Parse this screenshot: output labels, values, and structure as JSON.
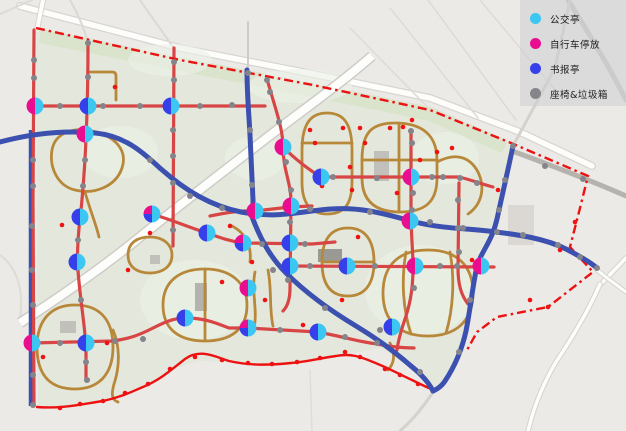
{
  "legend": {
    "items": [
      {
        "label": "公交亭",
        "color": "#3cc6f2"
      },
      {
        "label": "自行车停放",
        "color": "#e90e8f"
      },
      {
        "label": "书报亭",
        "color": "#3640ea"
      },
      {
        "label": "座椅&垃圾箱",
        "color": "#85858a"
      }
    ]
  },
  "map": {
    "colors": {
      "background": "#eceae7",
      "park_fill": "#e2e7da",
      "green_strip": "#d7e3c8",
      "field": "#edf1e8",
      "tan_path": "#b8883a",
      "red_road": "#d84545",
      "boundary_red": "#ec1212",
      "blue_route": "#3c50b0",
      "white_band": "#fdfdfc",
      "band_casing": "#cfccc7",
      "gray_dot": "#84848a",
      "red_dot": "#f01212",
      "marker_cyan": "#3cc6f2",
      "marker_magenta": "#e90e8f",
      "marker_blue": "#3640ea"
    },
    "outside_roads": [
      {
        "d": "M20,6 L180,48 L313,74 L430,98 L520,132 L592,166",
        "c": "#d8d5d0",
        "w": 8
      },
      {
        "d": "M20,6 L180,48 L313,74 L430,98 L520,132 L592,166",
        "c": "#fdfdfc",
        "w": 5.5
      },
      {
        "d": "M43,0 L37,30",
        "c": "#d8d5d0",
        "w": 6
      },
      {
        "d": "M43,0 L37,30",
        "c": "#fdfdfc",
        "w": 4
      },
      {
        "d": "M0,14 L32,0",
        "c": "#dedbd6",
        "w": 2
      },
      {
        "d": "M70,0 C78,14 84,28 88,42",
        "c": "#dcd9d4",
        "w": 2
      },
      {
        "d": "M140,0 C152,18 164,33 174,49",
        "c": "#dcd9d4",
        "w": 2
      },
      {
        "d": "M248,22 L248,70",
        "c": "#d0cdc8",
        "w": 2
      },
      {
        "d": "M390,8 L478,118",
        "c": "#dedbd6",
        "w": 1.5
      },
      {
        "d": "M428,0 L516,120",
        "c": "#dedbd6",
        "w": 1.5
      },
      {
        "d": "M350,28 L448,128",
        "c": "#dedbd6",
        "w": 1.5
      },
      {
        "d": "M480,0 L560,96",
        "c": "#dedbd6",
        "w": 1.5
      },
      {
        "d": "M568,0 C590,35 612,72 626,100",
        "c": "#cac7c2",
        "w": 5
      },
      {
        "d": "M513,146 L555,68 L570,0",
        "c": "#d5d2cd",
        "w": 3
      },
      {
        "d": "M515,152 C550,165 590,180 626,196",
        "c": "#b6b3ae",
        "w": 5
      },
      {
        "d": "M600,285 L626,258",
        "c": "#d5d2cd",
        "w": 5.5
      },
      {
        "d": "M600,285 L626,258",
        "c": "#fdfdfc",
        "w": 3.5
      },
      {
        "d": "M600,284 C588,312 572,338 556,362 C544,382 534,406 528,431",
        "c": "#d5d2cd",
        "w": 5.5
      },
      {
        "d": "M600,284 C588,312 572,338 556,362 C544,382 534,406 528,431",
        "c": "#fdfdfc",
        "w": 3.5
      },
      {
        "d": "M597,270 C608,279 618,286 626,292",
        "c": "#d5d2cd",
        "w": 5
      },
      {
        "d": "M597,270 C608,279 618,286 626,292",
        "c": "#fdfdfc",
        "w": 3
      },
      {
        "d": "M433,392 C420,412 410,422 400,431",
        "c": "#d5d2cd",
        "w": 3
      },
      {
        "d": "M310,370 L312,431",
        "c": "#e0ddd8",
        "w": 1.5
      },
      {
        "d": "M0,255 C18,268 24,292 20,318",
        "c": "#dedbd6",
        "w": 2
      }
    ],
    "park_outline": "36,28 180,58 313,84 430,108 513,146 505,190 494,226 479,252 471,300 461,345 440,390 410,367 380,348 350,354 312,359 270,365 228,362 200,361 170,370 143,388 115,396 80,405 38,408",
    "green_strip": "M40,36 L180,64 L313,90 L430,114 L505,147",
    "fields": [
      {
        "cx": 170,
        "cy": 60,
        "rx": 42,
        "ry": 16
      },
      {
        "cx": 300,
        "cy": 86,
        "rx": 52,
        "ry": 17
      },
      {
        "cx": 445,
        "cy": 158,
        "rx": 34,
        "ry": 26
      },
      {
        "cx": 120,
        "cy": 152,
        "rx": 38,
        "ry": 26
      },
      {
        "cx": 255,
        "cy": 158,
        "rx": 30,
        "ry": 22
      },
      {
        "cx": 195,
        "cy": 300,
        "rx": 55,
        "ry": 40
      },
      {
        "cx": 420,
        "cy": 290,
        "rx": 55,
        "ry": 45
      }
    ],
    "white_band": {
      "d": "M372,56 C335,88 300,112 264,140 C220,174 176,208 140,237 C102,268 60,297 20,323"
    },
    "buildings": [
      {
        "x": 318,
        "y": 249,
        "w": 24,
        "h": 13,
        "c": "#9b9993"
      },
      {
        "x": 374,
        "y": 151,
        "w": 15,
        "h": 30,
        "c": "#c2c0bb"
      },
      {
        "x": 195,
        "y": 283,
        "w": 12,
        "h": 28,
        "c": "#b5b3ae"
      },
      {
        "x": 60,
        "y": 321,
        "w": 16,
        "h": 12,
        "c": "#c2c0bb"
      },
      {
        "x": 150,
        "y": 255,
        "w": 10,
        "h": 9,
        "c": "#c2c0bb"
      },
      {
        "x": 508,
        "y": 205,
        "w": 26,
        "h": 40,
        "c": "#dbd8d3"
      }
    ],
    "tan_paths": [
      "M88,72 L112,72 Q116,72 116,76 L116,100",
      "M52,150 C55,132 75,127 92,131 C115,136 128,150 122,168 C116,186 95,195 75,190 C58,186 49,168 52,150 Z",
      "M85,192 C90,210 96,224 99,237",
      "M128,255 C128,243 137,237 150,237 C164,237 172,245 172,255 C172,267 162,273 150,273 C137,273 128,267 128,255 Z",
      "M37,347 C37,319 52,305 75,305 C100,305 113,320 113,347 C113,375 98,389 75,389 C50,389 37,375 37,347 Z",
      "M113,330 C120,346 120,366 114,384 C111,395 112,400 118,402",
      "M163,305 C163,281 180,269 205,269 C231,269 247,283 247,305 C247,330 230,341 205,341 C180,341 163,330 163,305 Z",
      "M205,269 L205,341",
      "M255,272 C251,292 258,310 254,328",
      "M268,270 C272,290 269,308 273,326",
      "M230,225 C245,232 252,245 250,262",
      "M302,150 C302,122 312,113 327,113 C344,113 352,124 352,150 L352,182 C352,206 343,214 327,214 C312,214 302,205 302,182 Z",
      "M302,143 L352,143",
      "M362,160 C362,132 372,123 395,123 C422,123 437,135 437,160 L437,178 C437,202 425,212 400,212 C375,212 362,201 362,178 Z",
      "M362,160 L437,160",
      "M399,123 L399,212",
      "M437,162 C456,152 470,157 478,172 C486,189 481,205 468,214",
      "M322,262 C322,238 332,228 348,228 C365,228 374,240 374,262 C374,285 364,296 348,296 C331,296 322,285 322,262 Z",
      "M322,262 L374,262",
      "M383,293 C383,264 400,250 428,250 C457,250 473,266 473,293 C473,322 455,336 428,336 C400,336 383,322 383,293 Z",
      "M406,252 C401,280 403,310 411,334",
      "M450,252 C455,280 453,310 446,333",
      "M390,343 C396,354 394,364 388,370"
    ],
    "under_blue": [
      "M31,130 L31,406"
    ],
    "red_roads": [
      "M34,30 L33,200 L34,405",
      "M88,42 C88,140 83,195 79,228 C77,252 77,262 79,282 C82,312 85,328 86,348 L86,380",
      "M174,48 L173,246",
      "M267,79 C275,108 283,128 283,147 C283,170 291,182 291,202 L290,288 C290,300 287,307 283,311",
      "M411,130 L411,210 C411,238 413,248 413,268 C413,292 409,308 404,322 C400,334 398,342 397,350",
      "M459,183 L458,268 C458,284 461,295 468,304",
      "M34,106 L265,106",
      "M283,147 C294,158 309,170 321,177 L459,177 C472,180 481,184 493,187",
      "M210,216 C225,213 241,210 255,211 L290,207 L312,206",
      "M152,214 C172,220 191,228 207,233 C221,238 229,241 243,243 L312,244 L335,242",
      "M288,266 L494,267",
      "M32,343 L112,341 C130,339 141,334 151,329 C163,323 173,318 185,318 C205,318 216,323 229,328 L248,328 L318,332 C340,336 359,342 377,344 C392,347 403,348 414,348"
    ],
    "boundary_dashdot": "M36,28 L180,60 L313,85 L430,110 L511,143 L588,176 L579,212 L570,247 L593,272 L548,307 L497,317 L477,332 L466,352",
    "bottom_boundary": "M37,407 C62,409 82,404 103,401 C122,397 133,391 143,387 C160,380 171,370 185,359 C200,348 216,357 229,361 C251,366 271,365 291,363 C306,362 321,358 336,356 C351,353 361,357 373,362 C386,367 401,375 414,381 C424,386 429,388 433,390",
    "blue_routes": [
      "M0,142 C30,134 62,130 95,133 C125,136 141,151 161,169 C186,191 211,206 241,212 C279,219 301,211 331,209 C361,207 381,213 411,221 C441,229 466,228 496,232 C521,235 546,239 566,249 C581,257 590,262 597,268",
      "M247,70 C247,95 249,115 250,135 C251,160 252,180 253,200 L253,212",
      "M513,146 C508,170 502,196 497,219 C491,245 480,251 476,271 C472,291 470,311 466,331 C462,349 455,366 445,381 C441,387 437,389 433,391",
      "M251,214 C259,236 269,256 286,273 C306,293 331,311 356,326 C376,338 396,353 411,366 C421,374 429,383 433,391"
    ],
    "markers": [
      {
        "x": 35,
        "y": 106,
        "t": "mc"
      },
      {
        "x": 88,
        "y": 106,
        "t": "bc"
      },
      {
        "x": 171,
        "y": 106,
        "t": "bc"
      },
      {
        "x": 85,
        "y": 134,
        "t": "mc"
      },
      {
        "x": 152,
        "y": 214,
        "t": "mbc"
      },
      {
        "x": 207,
        "y": 233,
        "t": "bc"
      },
      {
        "x": 243,
        "y": 243,
        "t": "mbc"
      },
      {
        "x": 255,
        "y": 211,
        "t": "mc"
      },
      {
        "x": 283,
        "y": 147,
        "t": "mc"
      },
      {
        "x": 321,
        "y": 177,
        "t": "bc"
      },
      {
        "x": 411,
        "y": 177,
        "t": "mc"
      },
      {
        "x": 291,
        "y": 206,
        "t": "mc"
      },
      {
        "x": 290,
        "y": 243,
        "t": "bc"
      },
      {
        "x": 290,
        "y": 266,
        "t": "bc"
      },
      {
        "x": 347,
        "y": 266,
        "t": "bc"
      },
      {
        "x": 415,
        "y": 266,
        "t": "mc"
      },
      {
        "x": 481,
        "y": 266,
        "t": "mc"
      },
      {
        "x": 80,
        "y": 217,
        "t": "bc"
      },
      {
        "x": 77,
        "y": 262,
        "t": "bc"
      },
      {
        "x": 410,
        "y": 221,
        "t": "mc"
      },
      {
        "x": 248,
        "y": 288,
        "t": "mc"
      },
      {
        "x": 248,
        "y": 328,
        "t": "mbc"
      },
      {
        "x": 318,
        "y": 332,
        "t": "bc"
      },
      {
        "x": 392,
        "y": 327,
        "t": "bc"
      },
      {
        "x": 185,
        "y": 318,
        "t": "bc"
      },
      {
        "x": 32,
        "y": 343,
        "t": "mc"
      },
      {
        "x": 86,
        "y": 343,
        "t": "bc"
      }
    ],
    "gray_dots": [
      [
        60,
        106
      ],
      [
        103,
        106
      ],
      [
        140,
        106
      ],
      [
        200,
        106
      ],
      [
        232,
        105
      ],
      [
        34,
        60
      ],
      [
        34,
        78
      ],
      [
        33,
        160
      ],
      [
        33,
        186
      ],
      [
        32,
        226
      ],
      [
        32,
        270
      ],
      [
        33,
        305
      ],
      [
        33,
        375
      ],
      [
        33,
        405
      ],
      [
        88,
        43
      ],
      [
        88,
        77
      ],
      [
        85,
        160
      ],
      [
        83,
        186
      ],
      [
        78,
        240
      ],
      [
        81,
        300
      ],
      [
        86,
        362
      ],
      [
        87,
        380
      ],
      [
        174,
        62
      ],
      [
        174,
        80
      ],
      [
        173,
        130
      ],
      [
        173,
        156
      ],
      [
        173,
        183
      ],
      [
        173,
        230
      ],
      [
        270,
        92
      ],
      [
        279,
        122
      ],
      [
        286,
        162
      ],
      [
        291,
        190
      ],
      [
        290,
        222
      ],
      [
        288,
        280
      ],
      [
        412,
        143
      ],
      [
        413,
        193
      ],
      [
        412,
        210
      ],
      [
        414,
        288
      ],
      [
        458,
        200
      ],
      [
        458,
        228
      ],
      [
        459,
        252
      ],
      [
        150,
        160
      ],
      [
        190,
        196
      ],
      [
        222,
        208
      ],
      [
        310,
        209
      ],
      [
        370,
        212
      ],
      [
        430,
        222
      ],
      [
        463,
        228
      ],
      [
        497,
        232
      ],
      [
        523,
        235
      ],
      [
        558,
        245
      ],
      [
        580,
        257
      ],
      [
        597,
        268
      ],
      [
        248,
        73
      ],
      [
        250,
        130
      ],
      [
        252,
        185
      ],
      [
        513,
        146
      ],
      [
        505,
        180
      ],
      [
        499,
        210
      ],
      [
        478,
        262
      ],
      [
        470,
        300
      ],
      [
        459,
        352
      ],
      [
        273,
        270
      ],
      [
        325,
        308
      ],
      [
        380,
        330
      ],
      [
        420,
        372
      ],
      [
        333,
        177
      ],
      [
        377,
        178
      ],
      [
        432,
        177
      ],
      [
        443,
        177
      ],
      [
        460,
        178
      ],
      [
        477,
        183
      ],
      [
        262,
        244
      ],
      [
        305,
        244
      ],
      [
        310,
        266
      ],
      [
        375,
        266
      ],
      [
        440,
        266
      ],
      [
        457,
        266
      ],
      [
        280,
        330
      ],
      [
        345,
        337
      ],
      [
        377,
        343
      ],
      [
        60,
        343
      ],
      [
        115,
        341
      ],
      [
        143,
        339
      ],
      [
        267,
        80
      ],
      [
        411,
        131
      ],
      [
        545,
        166
      ],
      [
        583,
        179
      ]
    ],
    "red_dots": [
      [
        115,
        87
      ],
      [
        343,
        128
      ],
      [
        403,
        127
      ],
      [
        315,
        143
      ],
      [
        365,
        143
      ],
      [
        350,
        167
      ],
      [
        437,
        152
      ],
      [
        412,
        120
      ],
      [
        397,
        193
      ],
      [
        322,
        186
      ],
      [
        352,
        190
      ],
      [
        310,
        130
      ],
      [
        360,
        128
      ],
      [
        390,
        128
      ],
      [
        420,
        160
      ],
      [
        452,
        148
      ],
      [
        472,
        260
      ],
      [
        498,
        190
      ],
      [
        43,
        357
      ],
      [
        107,
        343
      ],
      [
        128,
        270
      ],
      [
        62,
        225
      ],
      [
        150,
        233
      ],
      [
        230,
        226
      ],
      [
        252,
        262
      ],
      [
        222,
        282
      ],
      [
        265,
        300
      ],
      [
        303,
        325
      ],
      [
        342,
        300
      ],
      [
        358,
        237
      ],
      [
        60,
        408
      ],
      [
        80,
        404
      ],
      [
        103,
        401
      ],
      [
        125,
        393
      ],
      [
        148,
        384
      ],
      [
        170,
        369
      ],
      [
        195,
        357
      ],
      [
        222,
        360
      ],
      [
        248,
        363
      ],
      [
        272,
        364
      ],
      [
        297,
        362
      ],
      [
        320,
        358
      ],
      [
        345,
        352
      ],
      [
        360,
        357
      ],
      [
        385,
        369
      ],
      [
        400,
        375
      ],
      [
        418,
        384
      ],
      [
        548,
        307
      ],
      [
        530,
        300
      ],
      [
        560,
        250
      ],
      [
        575,
        222
      ]
    ]
  }
}
